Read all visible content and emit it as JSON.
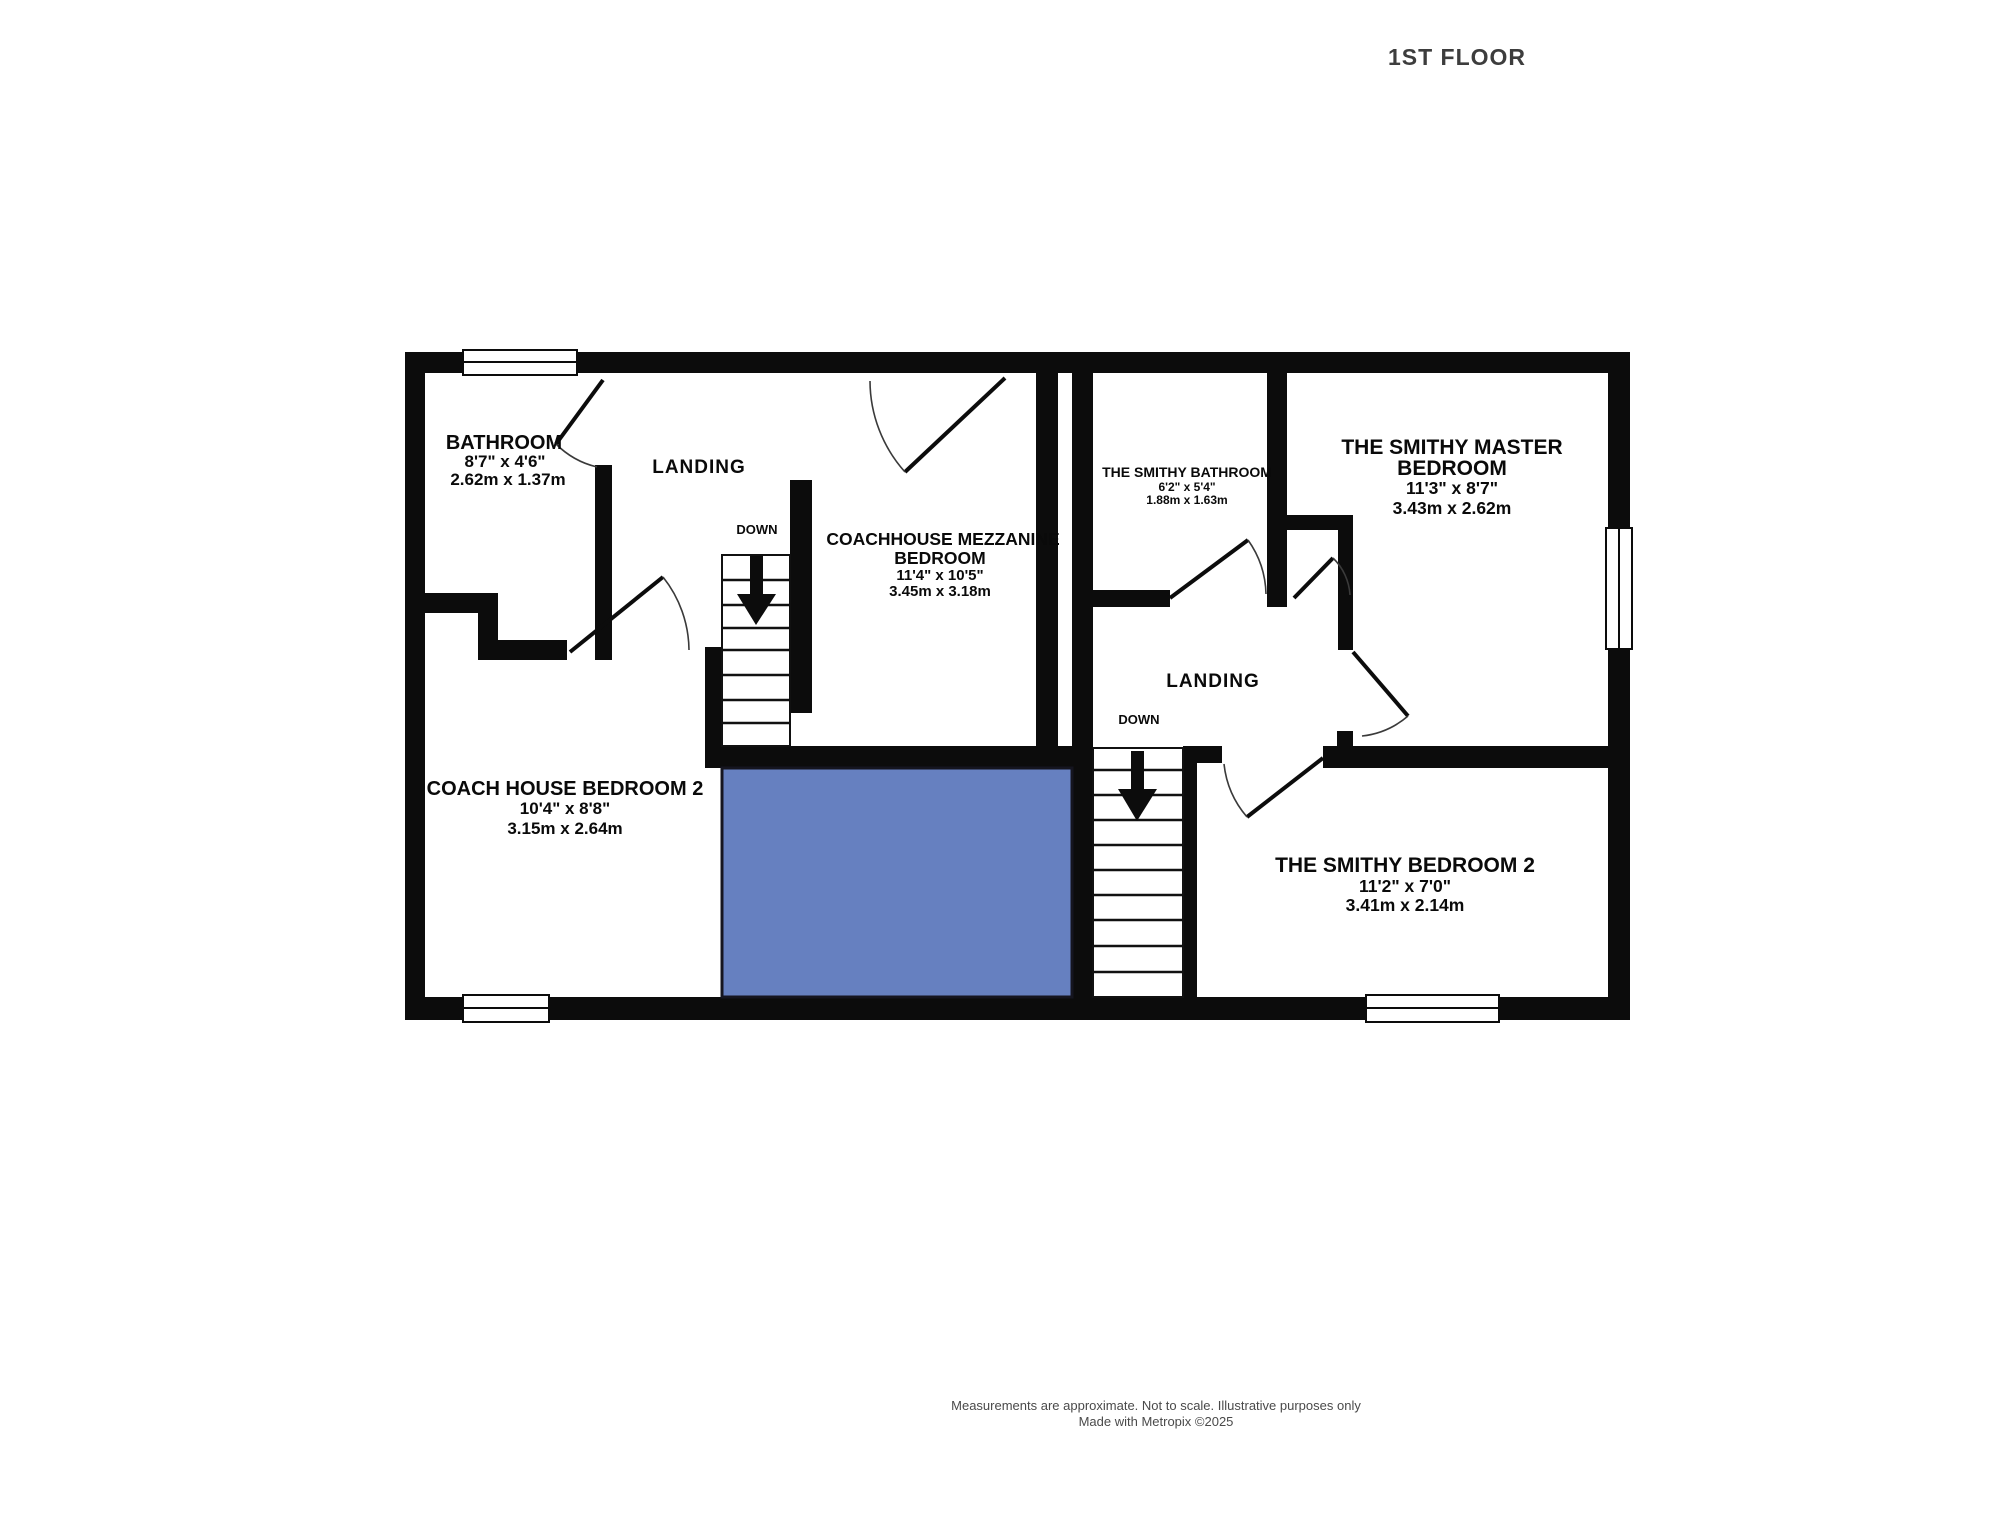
{
  "title": "1ST FLOOR",
  "colors": {
    "wall": "#0c0c0c",
    "void_fill": "#6680c0",
    "void_border": "#15151f"
  },
  "labels": {
    "bathroom": {
      "name": "BATHROOM",
      "imperial": "8'7\" x 4'6\"",
      "metric": "2.62m x 1.37m"
    },
    "landing_left": "LANDING",
    "down_left": "DOWN",
    "mezzanine": {
      "name1": "COACHHOUSE MEZZANINE",
      "name2": "BEDROOM",
      "imperial": "11'4\" x 10'5\"",
      "metric": "3.45m x 3.18m"
    },
    "coach_bedroom2": {
      "name": "COACH HOUSE BEDROOM 2",
      "imperial": "10'4\" x 8'8\"",
      "metric": "3.15m x 2.64m"
    },
    "smithy_bathroom": {
      "name": "THE SMITHY BATHROOM",
      "imperial": "6'2\" x 5'4\"",
      "metric": "1.88m x 1.63m"
    },
    "smithy_master": {
      "name1": "THE SMITHY MASTER",
      "name2": "BEDROOM",
      "imperial": "11'3\" x 8'7\"",
      "metric": "3.43m x 2.62m"
    },
    "landing_right": "LANDING",
    "down_right": "DOWN",
    "smithy_bedroom2": {
      "name": "THE SMITHY BEDROOM 2",
      "imperial": "11'2\" x 7'0\"",
      "metric": "3.41m x 2.14m"
    }
  },
  "footer": {
    "line1": "Measurements are approximate.  Not to scale.  Illustrative purposes only",
    "line2": "Made with Metropix ©2025"
  }
}
